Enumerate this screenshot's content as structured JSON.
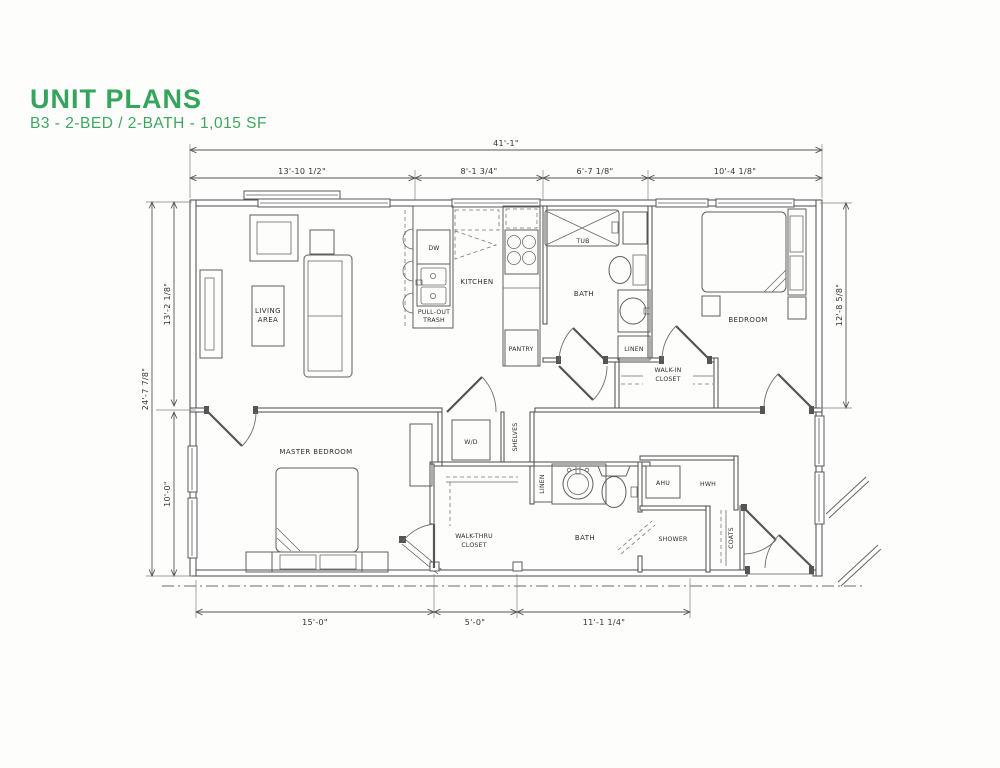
{
  "header": {
    "title": "UNIT PLANS",
    "subtitle": "B3 - 2-BED / 2-BATH - 1,015 SF"
  },
  "colors": {
    "title_green": "#35a45c",
    "line_gray": "#4a4a4a",
    "text_dark": "#2e2e2e"
  },
  "dims": {
    "overall_width": "41'-1\"",
    "w1": "13'-10 1/2\"",
    "w2": "8'-1 3/4\"",
    "w3": "6'-7 1/8\"",
    "w4": "10'-4 1/8\"",
    "overall_depth": "24'-7 7/8\"",
    "d1": "13'-2 1/8\"",
    "d2": "10'-0\"",
    "right_depth": "12'-8 5/8\"",
    "b1": "15'-0\"",
    "b2": "5'-0\"",
    "b3": "11'-1 1/4\""
  },
  "rooms": {
    "living1": "LIVING",
    "living2": "AREA",
    "kitchen": "KITCHEN",
    "bath1": "BATH",
    "bedroom": "BEDROOM",
    "walkin1": "WALK-IN",
    "walkin2": "CLOSET",
    "master": "MASTER BEDROOM",
    "walkthru1": "WALK-THRU",
    "walkthru2": "CLOSET",
    "bath2": "BATH",
    "shower": "SHOWER"
  },
  "fixtures": {
    "dw": "DW",
    "pullout1": "PULL-OUT",
    "pullout2": "TRASH",
    "pantry": "PANTRY",
    "tub": "TUB",
    "linen1": "LINEN",
    "linen2": "LINEN",
    "wd": "W/D",
    "shelves": "SHELVES",
    "ahu": "AHU",
    "hwh": "HWH",
    "coats": "COATS"
  }
}
